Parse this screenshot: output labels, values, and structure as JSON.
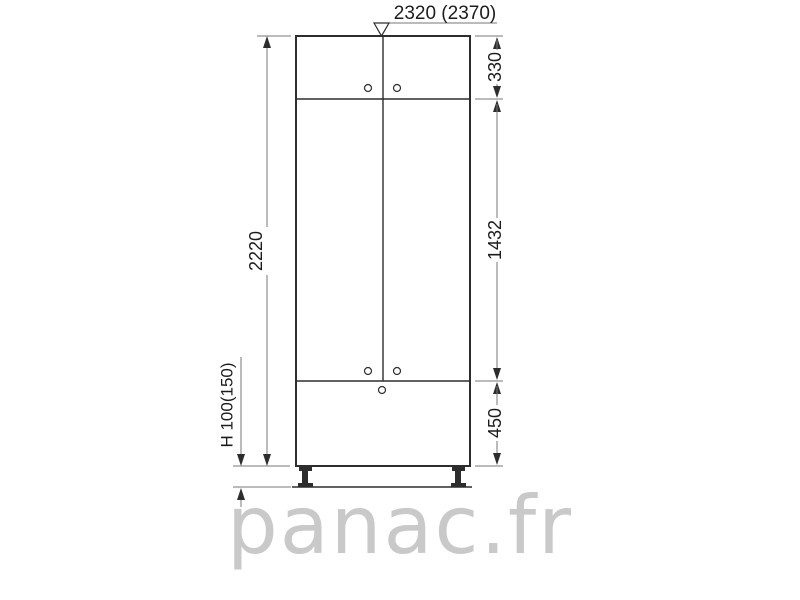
{
  "figure": {
    "type": "kitchen-column-cabinet-elevation-drawing",
    "watermark": "panac.fr"
  },
  "dimensions": {
    "total_width": "2320 (2370)",
    "total_height": "2220",
    "plinth_height": "H 100(150)",
    "top_section_height": "330",
    "middle_section_height": "1432",
    "bottom_section_height": "450"
  },
  "colors": {
    "line": "#2d2d2d",
    "dim_line": "#777777",
    "text": "#1c1c1c",
    "watermark": "#c9c9c9",
    "background": "#ffffff"
  }
}
